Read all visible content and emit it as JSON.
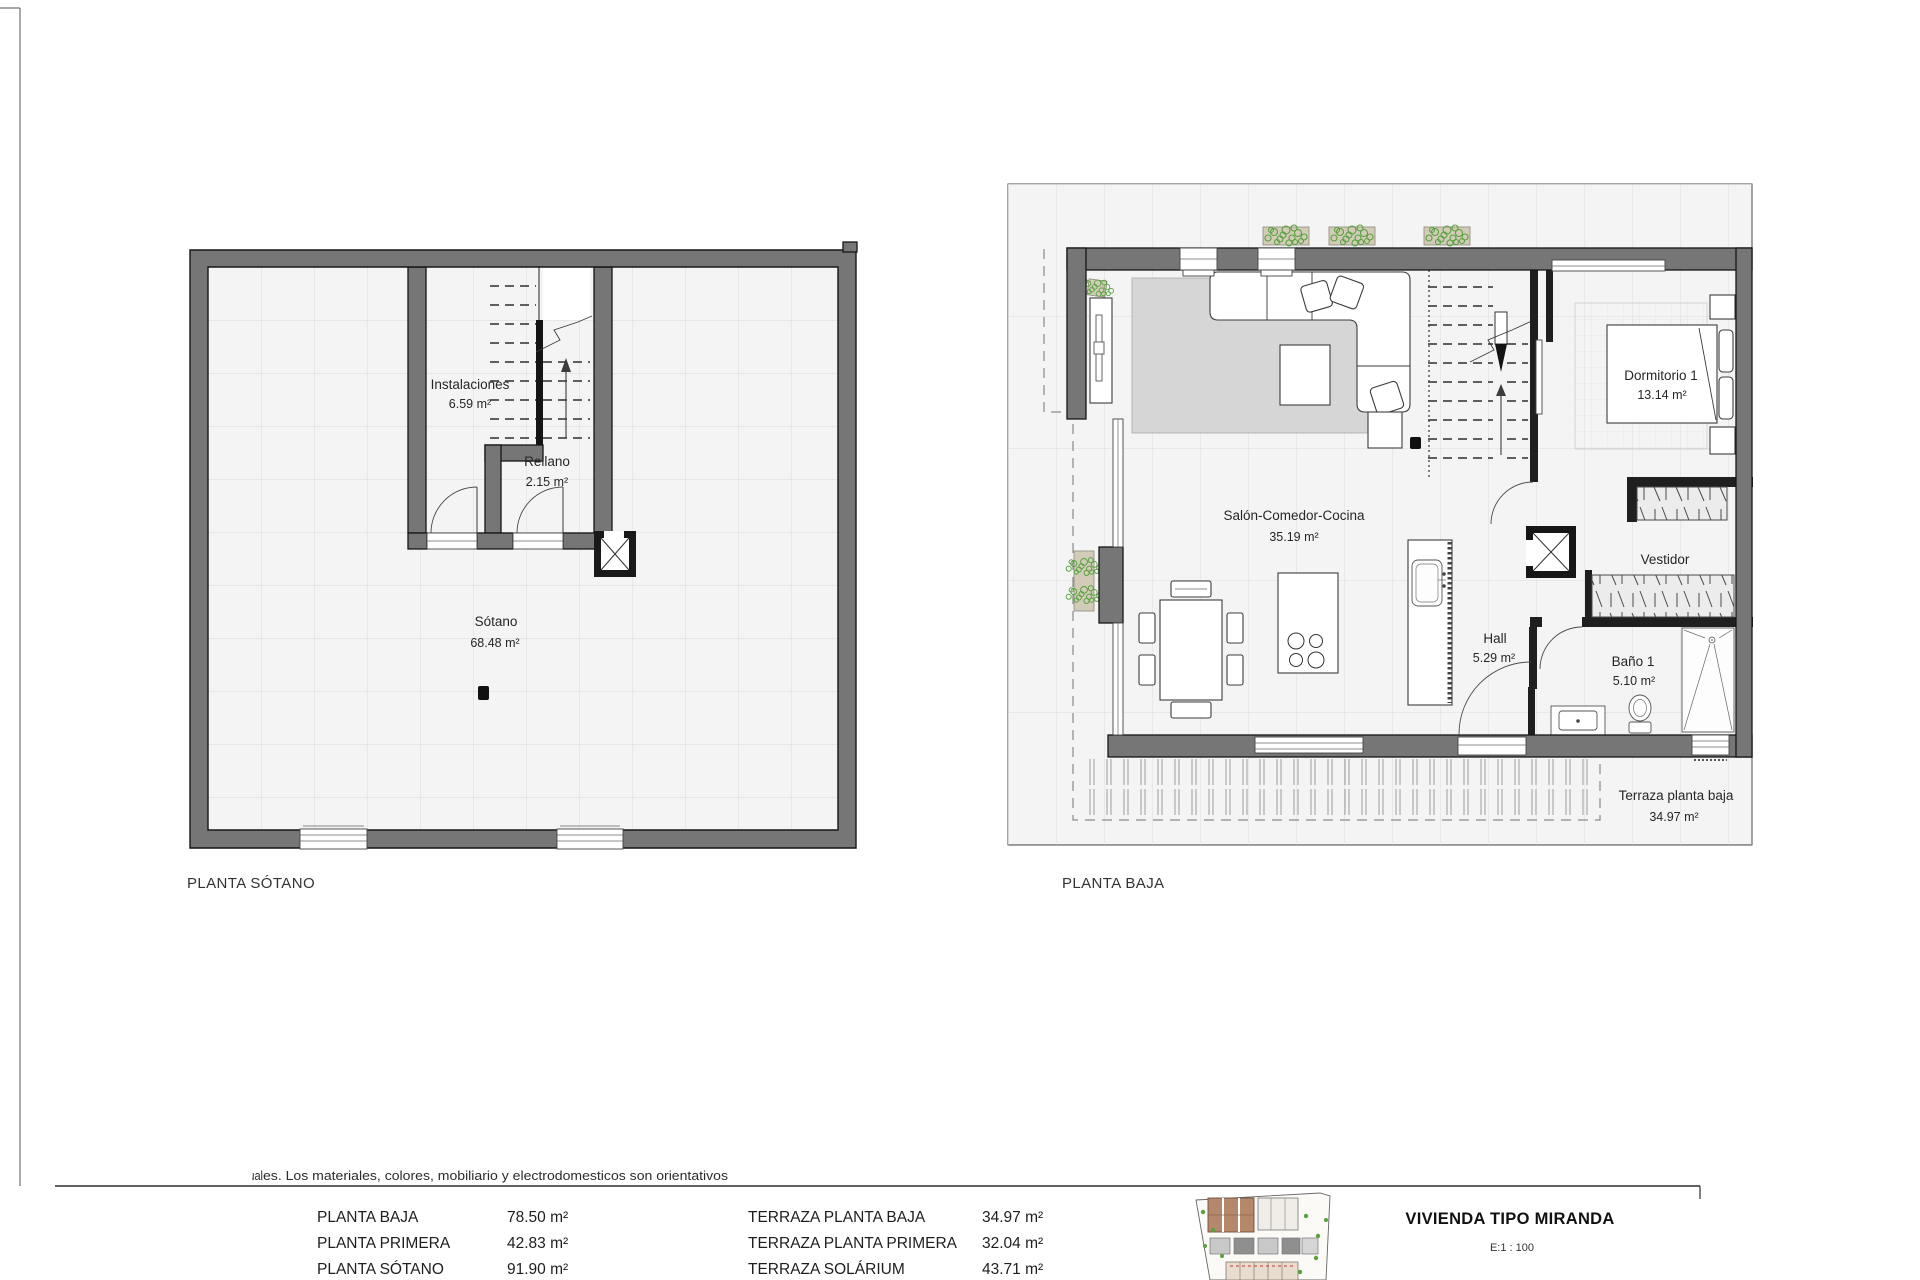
{
  "plans": {
    "sotano": {
      "title": "PLANTA SÓTANO",
      "rooms": {
        "instalaciones": {
          "name": "Instalaciones",
          "area": "6.59 m²"
        },
        "rellano": {
          "name": "Rellano",
          "area": "2.15 m²"
        },
        "sotano": {
          "name": "Sótano",
          "area": "68.48 m²"
        }
      }
    },
    "baja": {
      "title": "PLANTA BAJA",
      "rooms": {
        "salon": {
          "name": "Salón-Comedor-Cocina",
          "area": "35.19 m²"
        },
        "dormitorio1": {
          "name": "Dormitorio 1",
          "area": "13.14 m²"
        },
        "vestidor": {
          "name": "Vestidor"
        },
        "hall": {
          "name": "Hall",
          "area": "5.29 m²"
        },
        "bano1": {
          "name": "Baño 1",
          "area": "5.10 m²"
        },
        "terraza": {
          "name": "Terraza planta baja",
          "area": "34.97 m²"
        }
      }
    }
  },
  "title_block": {
    "disclaimer_occluded_prefix": "Plano de inicio ilustrativo no contractual",
    "disclaimer_visible": "es. Los materiales, colores, mobiliario y electrodomesticos son orientativos",
    "surface_table": {
      "left_column": [
        {
          "label": "PLANTA BAJA",
          "value": "78.50 m²"
        },
        {
          "label": "PLANTA PRIMERA",
          "value": "42.83 m²"
        },
        {
          "label": "PLANTA SÓTANO",
          "value": "91.90 m²"
        }
      ],
      "right_column": [
        {
          "label": "TERRAZA PLANTA BAJA",
          "value": "34.97 m²"
        },
        {
          "label": "TERRAZA PLANTA PRIMERA",
          "value": "32.04 m²"
        },
        {
          "label": "TERRAZA SOLÁRIUM",
          "value": "43.71 m²"
        }
      ]
    },
    "project_title": "VIVIENDA TIPO MIRANDA",
    "scale_label": "E:1 : 100"
  },
  "theme": {
    "wall-gray": "#767676",
    "wall-dark": "#1f1f1f",
    "floor": "#f4f4f4",
    "grid-line": "#d6d6d6",
    "rug": "#d6d6d6",
    "plant-green": "#55a23c",
    "planter-tan": "#d2cbb8",
    "site-brown": "#b5886b",
    "text": "#262626"
  }
}
